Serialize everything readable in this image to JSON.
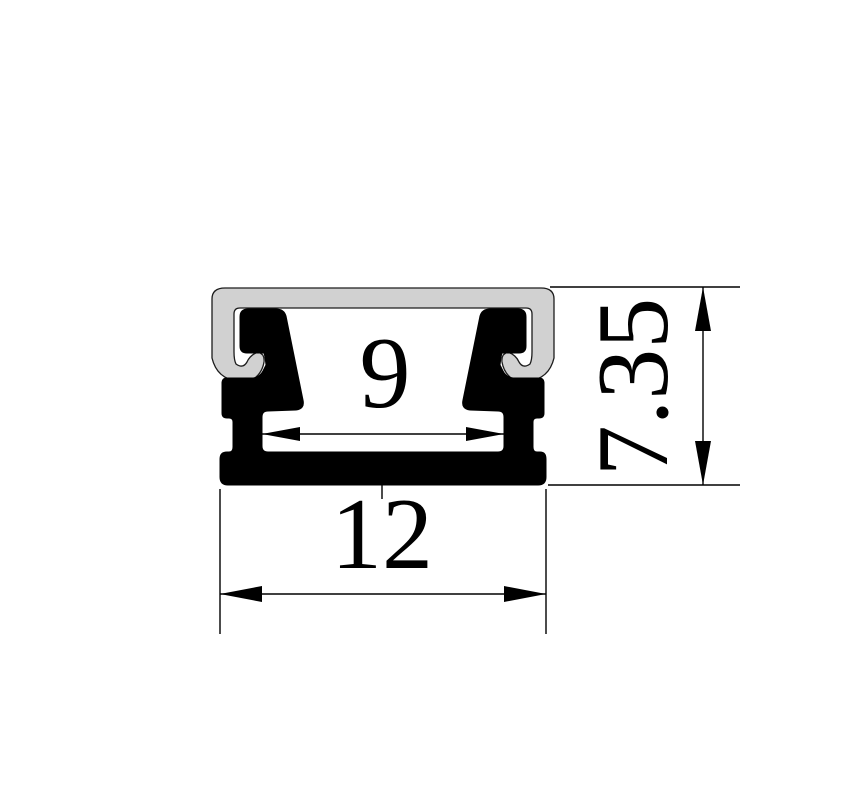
{
  "drawing": {
    "dimensions": {
      "inner_width": "9",
      "outer_width": "12",
      "height": "7.35"
    },
    "colors": {
      "outline": "#000000",
      "body": "#000000",
      "cover": "#d1d1d1",
      "background": "#ffffff"
    }
  }
}
